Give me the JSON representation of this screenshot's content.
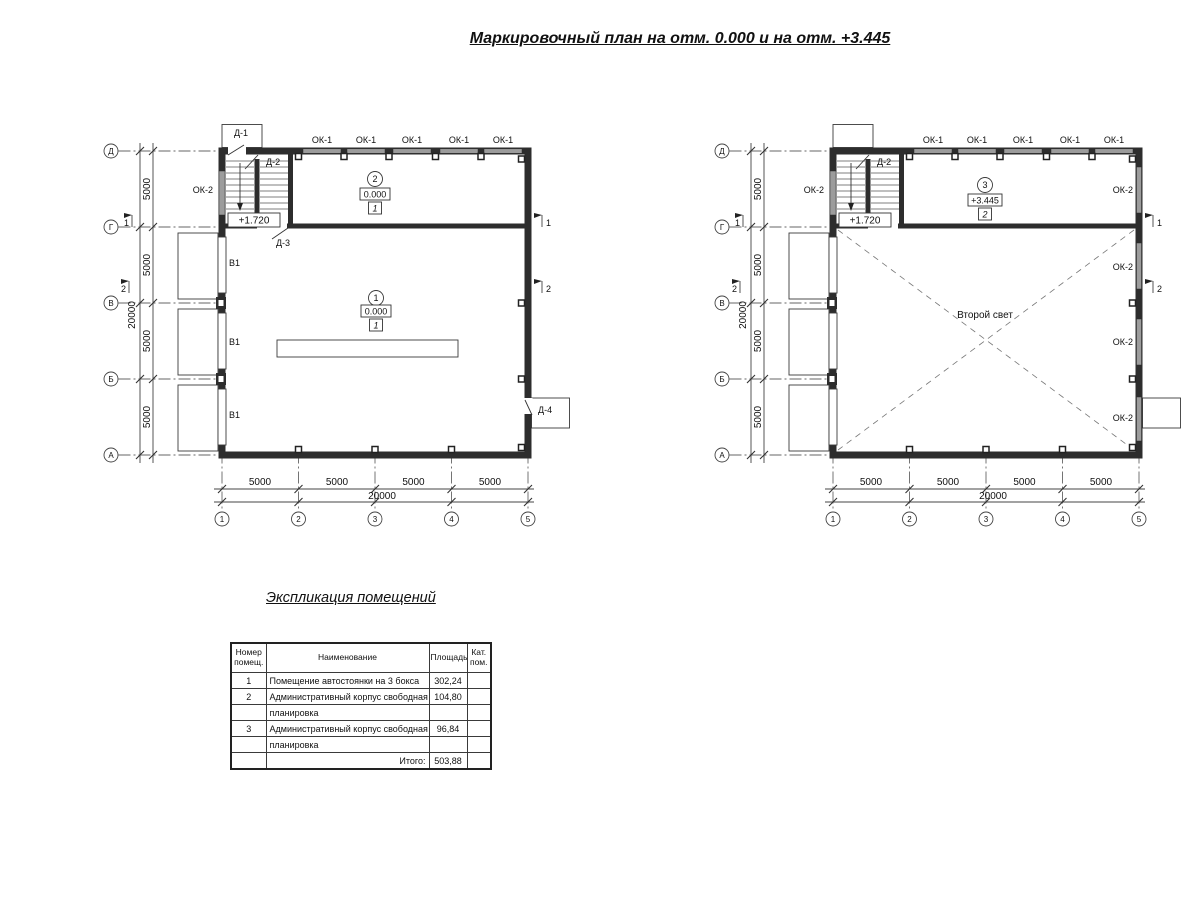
{
  "title": "Маркировочный план на отм. 0.000 и на отм. +3.445",
  "axes": {
    "rows": [
      "Д",
      "Г",
      "В",
      "Б",
      "А"
    ],
    "cols": [
      "1",
      "2",
      "3",
      "4",
      "5"
    ],
    "v_dims": [
      "5000",
      "5000",
      "5000",
      "5000"
    ],
    "v_total": "20000",
    "h_dims": [
      "5000",
      "5000",
      "5000",
      "5000"
    ],
    "h_total": "20000"
  },
  "section_marks": {
    "s1": "1",
    "s2": "2"
  },
  "plan_left": {
    "ok1": [
      "ОК-1",
      "ОК-1",
      "ОК-1",
      "ОК-1",
      "ОК-1"
    ],
    "ok2_left": "ОК-2",
    "doors": {
      "d1": "Д-1",
      "d2": "Д-2",
      "d3": "Д-3",
      "d4": "Д-4"
    },
    "gates": [
      "В1",
      "В1",
      "В1"
    ],
    "stair_level": "+1.720",
    "room2": {
      "num": "2",
      "level": "0.000",
      "cat": "1"
    },
    "room1": {
      "num": "1",
      "level": "0.000",
      "cat": "1"
    }
  },
  "plan_right": {
    "ok1": [
      "ОК-1",
      "ОК-1",
      "ОК-1",
      "ОК-1",
      "ОК-1"
    ],
    "ok2_left": "ОК-2",
    "ok2_right": [
      "ОК-2",
      "ОК-2",
      "ОК-2",
      "ОК-2"
    ],
    "doors": {
      "d2": "Д-2"
    },
    "stair_level": "+1.720",
    "room3": {
      "num": "3",
      "level": "+3.445",
      "cat": "2"
    },
    "second_light": "Второй свет"
  },
  "table": {
    "title": "Экспликация помещений",
    "headers": {
      "num": "Номер помещ.",
      "name": "Наименование",
      "area": "Площадь",
      "cat": "Кат. пом."
    },
    "rows": [
      {
        "num": "1",
        "name": "Помещение автостоянки на 3 бокса",
        "area": "302,24",
        "cat": ""
      },
      {
        "num": "2",
        "name": "Административный корпус свободная",
        "area": "104,80",
        "cat": ""
      },
      {
        "num": "",
        "name": "планировка",
        "area": "",
        "cat": ""
      },
      {
        "num": "3",
        "name": "Административный корпус свободная",
        "area": "96,84",
        "cat": ""
      },
      {
        "num": "",
        "name": "планировка",
        "area": "",
        "cat": ""
      }
    ],
    "total_label": "Итого:",
    "total_value": "503,88"
  }
}
